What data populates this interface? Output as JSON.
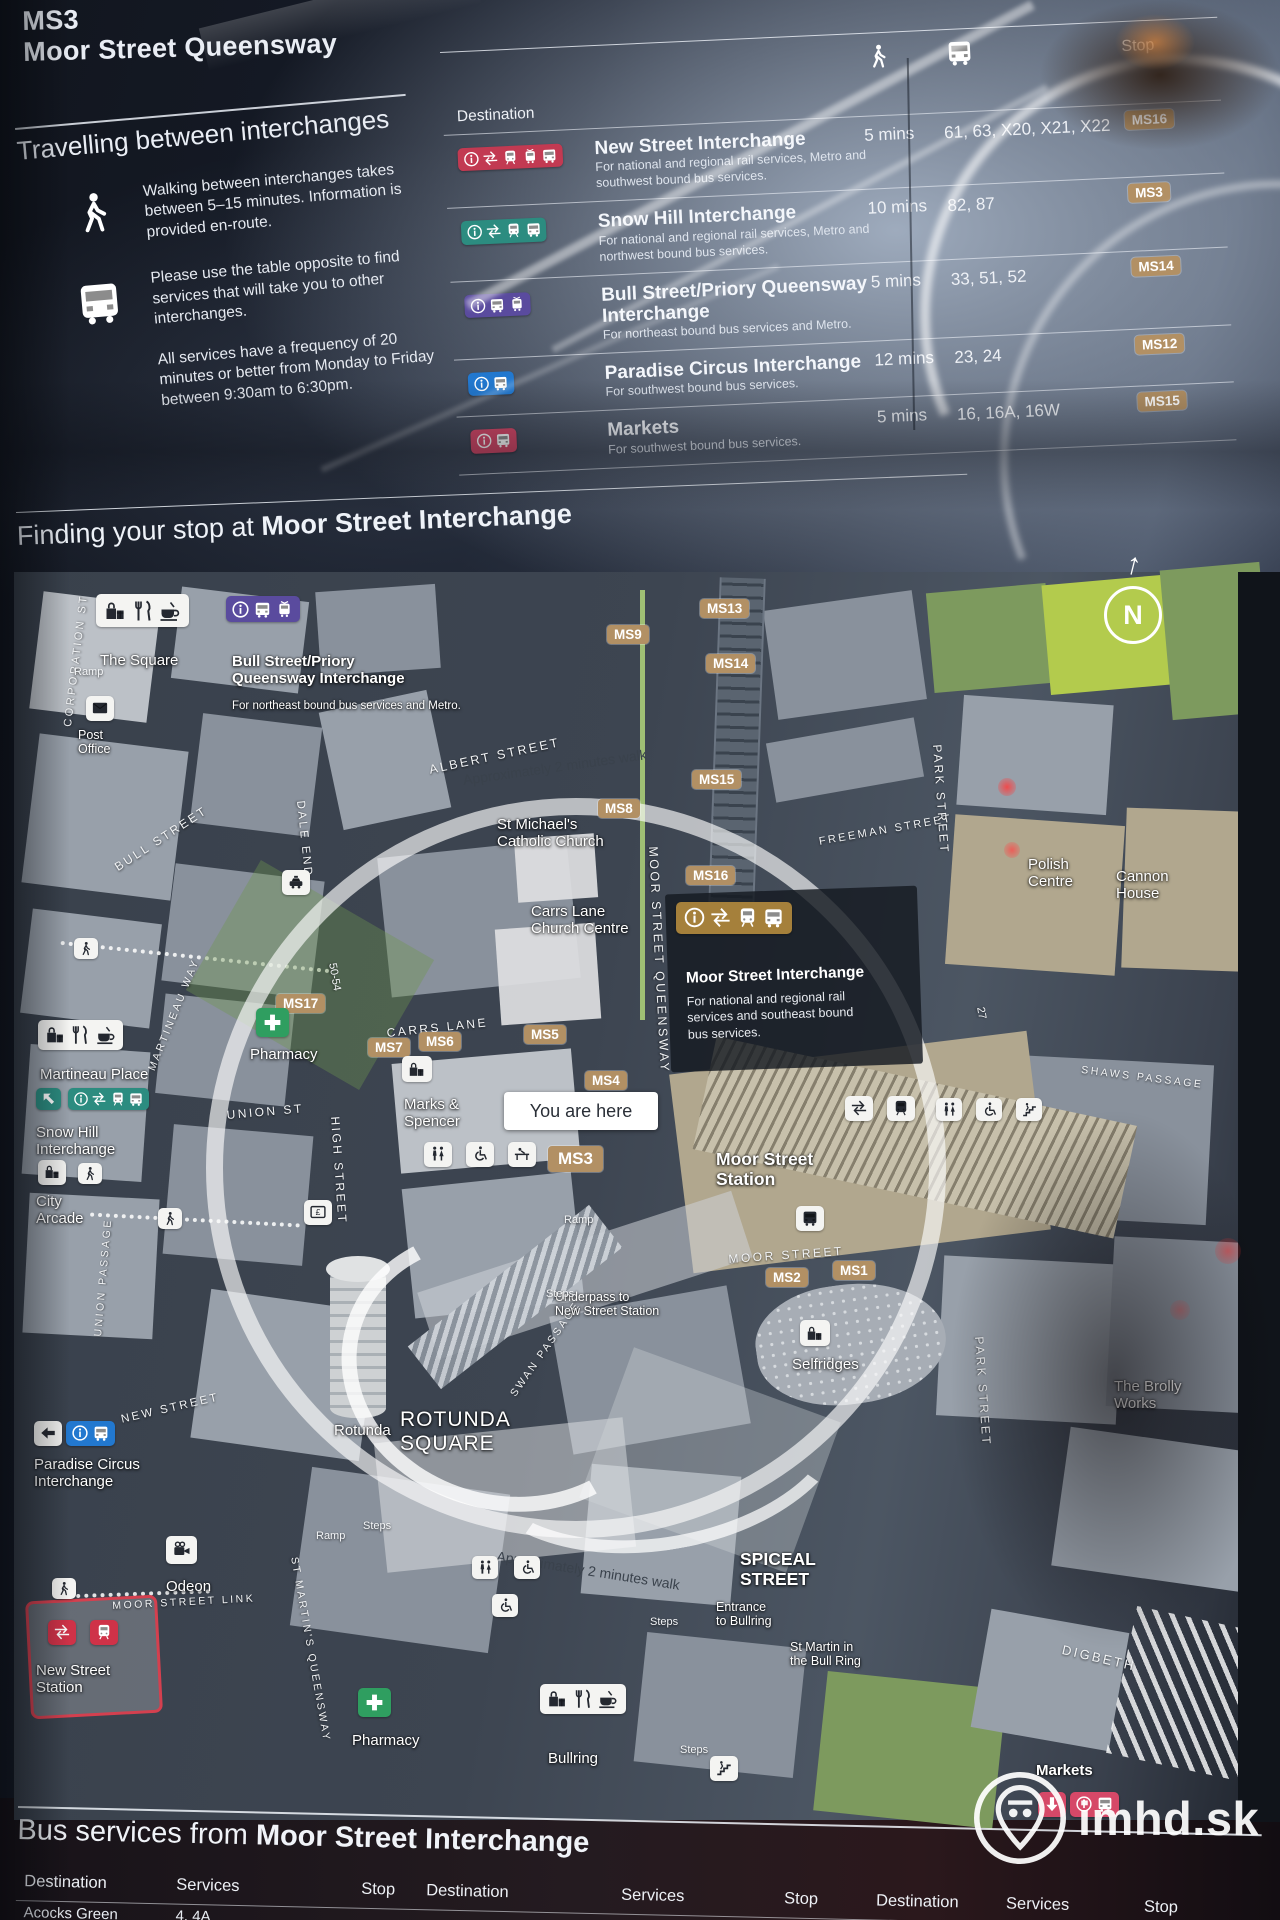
{
  "header": {
    "stop_code": "MS3",
    "stop_name": "Moor Street Queensway"
  },
  "travel_info": {
    "heading": "Travelling between interchanges",
    "walk_note": "Walking between interchanges takes between 5–15 minutes. Information is provided en-route.",
    "bus_note_1": "Please use the table opposite to find services that will take you to other interchanges.",
    "bus_note_2": "All services have a frequency of 20 minutes or better from Monday to Friday between 9:30am to 6:30pm."
  },
  "interchange_table": {
    "destination_header": "Destination",
    "stop_header": "Stop",
    "rows": [
      {
        "title": "New Street Interchange",
        "subtitle": "For national and regional rail services, Metro and southwest bound bus services.",
        "walk_time": "5 mins",
        "services": "61, 63, X20, X21, X22",
        "stop": "MS16",
        "chip_color": "red",
        "chip_icons": [
          "info",
          "rail",
          "train",
          "tram",
          "bus"
        ]
      },
      {
        "title": "Snow Hill Interchange",
        "subtitle": "For national and regional rail services, Metro and northwest bound bus services.",
        "walk_time": "10 mins",
        "services": "82, 87",
        "stop": "MS3",
        "chip_color": "teal",
        "chip_icons": [
          "info",
          "rail",
          "train",
          "bus"
        ]
      },
      {
        "title": "Bull Street/Priory Queensway Interchange",
        "subtitle": "For northeast bound bus services and Metro.",
        "walk_time": "5 mins",
        "services": "33, 51, 52",
        "stop": "MS14",
        "chip_color": "purple",
        "chip_icons": [
          "info",
          "bus",
          "tram"
        ]
      },
      {
        "title": "Paradise Circus Interchange",
        "subtitle": "For southwest bound bus services.",
        "walk_time": "12 mins",
        "services": "23, 24",
        "stop": "MS12",
        "chip_color": "blue",
        "chip_icons": [
          "info",
          "bus"
        ]
      },
      {
        "title": "Markets",
        "subtitle": "For southwest bound bus services.",
        "walk_time": "5 mins",
        "services": "16, 16A, 16W",
        "stop": "MS15",
        "chip_color": "pink",
        "chip_icons": [
          "info",
          "bus"
        ]
      }
    ]
  },
  "map_section": {
    "heading_prefix": "Finding your stop at ",
    "heading_bold": "Moor Street Interchange"
  },
  "map": {
    "you_are_here": "You are here",
    "north": "N",
    "north_arrow": "↑",
    "moor_panel": {
      "title": "Moor Street Interchange",
      "sub": "For national and regional rail\nservices and southeast bound\nbus services."
    },
    "streets": [
      {
        "t": "CORPORATION ST",
        "x": 62,
        "y": 726,
        "r": -83,
        "fs": 11
      },
      {
        "t": "BULL STREET",
        "x": 112,
        "y": 862,
        "r": -33,
        "fs": 12
      },
      {
        "t": "DALE END",
        "x": 306,
        "y": 800,
        "r": 84,
        "fs": 11.5
      },
      {
        "t": "ALBERT STREET",
        "x": 428,
        "y": 763,
        "r": -12,
        "fs": 12.5
      },
      {
        "t": "MARTINEAU WAY",
        "x": 146,
        "y": 1068,
        "r": -68,
        "fs": 10.5
      },
      {
        "t": "UNION ST",
        "x": 226,
        "y": 1108,
        "r": -5,
        "fs": 12
      },
      {
        "t": "HIGH STREET",
        "x": 342,
        "y": 1116,
        "r": 86,
        "fs": 12
      },
      {
        "t": "UNION PASSAGE",
        "x": 92,
        "y": 1336,
        "r": -85,
        "fs": 10.5
      },
      {
        "t": "CARRS LANE",
        "x": 386,
        "y": 1026,
        "r": -6,
        "fs": 12
      },
      {
        "t": "MOOR STREET QUEENSWAY",
        "x": 660,
        "y": 846,
        "r": 87,
        "fs": 12.5
      },
      {
        "t": "FREEMAN STREET",
        "x": 818,
        "y": 836,
        "r": -10,
        "fs": 11
      },
      {
        "t": "PARK STREET",
        "x": 944,
        "y": 744,
        "r": 86,
        "fs": 12
      },
      {
        "t": "PARK STREET",
        "x": 986,
        "y": 1336,
        "r": 86,
        "fs": 12
      },
      {
        "t": "SHAWS PASSAGE",
        "x": 1082,
        "y": 1064,
        "r": 7,
        "fs": 10.5
      },
      {
        "t": "MOOR STREET",
        "x": 728,
        "y": 1252,
        "r": -4,
        "fs": 12
      },
      {
        "t": "SWAN PASSAGE",
        "x": 508,
        "y": 1392,
        "r": -55,
        "fs": 10.5
      },
      {
        "t": "NEW STREET",
        "x": 120,
        "y": 1414,
        "r": -13,
        "fs": 11.5
      },
      {
        "t": "ST MARTIN'S QUEENSWAY",
        "x": 300,
        "y": 1556,
        "r": 80,
        "fs": 10.5
      },
      {
        "t": "MOOR STREET LINK",
        "x": 112,
        "y": 1600,
        "r": -3,
        "fs": 10.5
      },
      {
        "t": "DIGBETH",
        "x": 1064,
        "y": 1642,
        "r": 13,
        "fs": 13
      }
    ],
    "stop_chips": [
      {
        "t": "MS13",
        "x": 700,
        "y": 599
      },
      {
        "t": "MS9",
        "x": 607,
        "y": 625
      },
      {
        "t": "MS14",
        "x": 706,
        "y": 654
      },
      {
        "t": "MS15",
        "x": 692,
        "y": 770
      },
      {
        "t": "MS8",
        "x": 598,
        "y": 799
      },
      {
        "t": "MS16",
        "x": 686,
        "y": 866
      },
      {
        "t": "MS17",
        "x": 276,
        "y": 994
      },
      {
        "t": "MS7",
        "x": 368,
        "y": 1038
      },
      {
        "t": "MS6",
        "x": 419,
        "y": 1032
      },
      {
        "t": "MS5",
        "x": 524,
        "y": 1025
      },
      {
        "t": "MS4",
        "x": 585,
        "y": 1071
      },
      {
        "t": "MS3",
        "x": 548,
        "y": 1146,
        "big": true
      },
      {
        "t": "MS2",
        "x": 766,
        "y": 1268
      },
      {
        "t": "MS1",
        "x": 833,
        "y": 1261
      }
    ],
    "pois": [
      {
        "t": "The Square",
        "x": 100,
        "y": 652,
        "cls": "md"
      },
      {
        "t": "Post\nOffice",
        "x": 78,
        "y": 728,
        "cls": "sm"
      },
      {
        "t": "Bull Street/Priory\nQueensway Interchange",
        "x": 232,
        "y": 653,
        "cls": "md b"
      },
      {
        "t": "For northeast bound bus services and Metro.",
        "x": 232,
        "y": 700,
        "cls": "xs"
      },
      {
        "t": "St Michael's\nCatholic Church",
        "x": 497,
        "y": 816,
        "cls": "md"
      },
      {
        "t": "Carrs Lane\nChurch Centre",
        "x": 531,
        "y": 903,
        "cls": "md"
      },
      {
        "t": "Polish\nCentre",
        "x": 1028,
        "y": 856,
        "cls": "md"
      },
      {
        "t": "Cannon\nHouse",
        "x": 1116,
        "y": 868,
        "cls": "md"
      },
      {
        "t": "Pharmacy",
        "x": 250,
        "y": 1046,
        "cls": "md"
      },
      {
        "t": "Marks &\nSpencer",
        "x": 404,
        "y": 1096,
        "cls": "md"
      },
      {
        "t": "Martineau Place",
        "x": 40,
        "y": 1066,
        "cls": "md"
      },
      {
        "t": "Snow Hill\nInterchange",
        "x": 36,
        "y": 1124,
        "cls": "md"
      },
      {
        "t": "City\nArcade",
        "x": 36,
        "y": 1193,
        "cls": "md"
      },
      {
        "t": "Moor Street\nStation",
        "x": 716,
        "y": 1150,
        "cls": "lg"
      },
      {
        "t": "Underpass to\nNew Street Station",
        "x": 555,
        "y": 1290,
        "cls": "sm"
      },
      {
        "t": "Selfridges",
        "x": 792,
        "y": 1356,
        "cls": "md"
      },
      {
        "t": "Rotunda",
        "x": 334,
        "y": 1422,
        "cls": "md"
      },
      {
        "t": "ROTUNDA\nSQUARE",
        "x": 400,
        "y": 1408,
        "cls": "xl"
      },
      {
        "t": "Paradise Circus\nInterchange",
        "x": 34,
        "y": 1456,
        "cls": "md"
      },
      {
        "t": "Odeon",
        "x": 166,
        "y": 1578,
        "cls": "md"
      },
      {
        "t": "New Street\nStation",
        "x": 36,
        "y": 1662,
        "cls": "md"
      },
      {
        "t": "The Brolly\nWorks",
        "x": 1114,
        "y": 1378,
        "cls": "md"
      },
      {
        "t": "SPICEAL\nSTREET",
        "x": 740,
        "y": 1550,
        "cls": "lg"
      },
      {
        "t": "Entrance\nto Bullring",
        "x": 716,
        "y": 1600,
        "cls": "sm"
      },
      {
        "t": "St Martin in\nthe Bull Ring",
        "x": 790,
        "y": 1640,
        "cls": "sm"
      },
      {
        "t": "Bullring",
        "x": 548,
        "y": 1750,
        "cls": "md"
      },
      {
        "t": "Pharmacy",
        "x": 352,
        "y": 1732,
        "cls": "md"
      },
      {
        "t": "Markets",
        "x": 1036,
        "y": 1762,
        "cls": "md b"
      }
    ],
    "notes": [
      {
        "t": "Approximately 2 minutes walk",
        "x": 462,
        "y": 772,
        "r": -8
      },
      {
        "t": "Approximately 2 minutes walk",
        "x": 498,
        "y": 1548,
        "r": 9
      }
    ],
    "small_labels": [
      {
        "t": "Ramp",
        "x": 74,
        "y": 666
      },
      {
        "t": "Ramp",
        "x": 564,
        "y": 1214
      },
      {
        "t": "Ramp",
        "x": 316,
        "y": 1530
      },
      {
        "t": "Steps",
        "x": 546,
        "y": 1288
      },
      {
        "t": "Steps",
        "x": 363,
        "y": 1520
      },
      {
        "t": "Steps",
        "x": 650,
        "y": 1616
      },
      {
        "t": "Steps",
        "x": 680,
        "y": 1744
      },
      {
        "t": "50-54",
        "x": 338,
        "y": 962,
        "r": 80
      },
      {
        "t": "27",
        "x": 986,
        "y": 1006,
        "r": 80
      }
    ],
    "icon_chips": [
      {
        "x": 96,
        "y": 594,
        "style": "white",
        "icons": [
          "gift",
          "fork",
          "cup"
        ],
        "s": 1.5
      },
      {
        "x": 226,
        "y": 596,
        "style": "purple",
        "icons": [
          "info",
          "bus",
          "tram"
        ],
        "s": 1.2
      },
      {
        "x": 86,
        "y": 696,
        "style": "white",
        "icons": [
          "envelope"
        ],
        "s": 1.1
      },
      {
        "x": 282,
        "y": 870,
        "style": "white",
        "icons": [
          "taxi"
        ],
        "s": 1.1
      },
      {
        "x": 256,
        "y": 1008,
        "style": "green",
        "icons": [
          "cross"
        ],
        "s": 1.3
      },
      {
        "x": 358,
        "y": 1688,
        "style": "green",
        "icons": [
          "cross"
        ],
        "s": 1.3
      },
      {
        "x": 38,
        "y": 1020,
        "style": "white",
        "icons": [
          "gift",
          "fork",
          "cup"
        ],
        "s": 1.35
      },
      {
        "x": 36,
        "y": 1088,
        "style": "teal",
        "icons": [
          "arrow-upleft"
        ],
        "s": 1.0
      },
      {
        "x": 68,
        "y": 1088,
        "style": "teal",
        "icons": [
          "info",
          "rail",
          "train",
          "bus"
        ],
        "s": 1.0
      },
      {
        "x": 38,
        "y": 1160,
        "style": "white",
        "icons": [
          "gift"
        ],
        "s": 1.15
      },
      {
        "x": 74,
        "y": 938,
        "style": "white",
        "icons": [
          "walk"
        ],
        "s": 0.95
      },
      {
        "x": 78,
        "y": 1163,
        "style": "white",
        "icons": [
          "walk"
        ],
        "s": 0.95
      },
      {
        "x": 158,
        "y": 1208,
        "style": "white",
        "icons": [
          "walk"
        ],
        "s": 0.95
      },
      {
        "x": 304,
        "y": 1200,
        "style": "white",
        "icons": [
          "cash"
        ],
        "s": 1.1
      },
      {
        "x": 402,
        "y": 1056,
        "style": "white",
        "icons": [
          "gift"
        ],
        "s": 1.2
      },
      {
        "x": 424,
        "y": 1142,
        "style": "white",
        "icons": [
          "toilets"
        ],
        "s": 1.1
      },
      {
        "x": 466,
        "y": 1142,
        "style": "white",
        "icons": [
          "wheelchair"
        ],
        "s": 1.1
      },
      {
        "x": 508,
        "y": 1142,
        "style": "white",
        "icons": [
          "baby"
        ],
        "s": 1.1
      },
      {
        "x": 676,
        "y": 902,
        "style": "gold",
        "icons": [
          "info",
          "rail",
          "train",
          "bus"
        ],
        "s": 1.45
      },
      {
        "x": 845,
        "y": 1096,
        "style": "white",
        "icons": [
          "rail"
        ],
        "s": 1.15
      },
      {
        "x": 887,
        "y": 1096,
        "style": "white",
        "icons": [
          "train"
        ],
        "s": 1.15
      },
      {
        "x": 936,
        "y": 1098,
        "style": "white",
        "icons": [
          "toilets"
        ],
        "s": 1.05
      },
      {
        "x": 976,
        "y": 1098,
        "style": "white",
        "icons": [
          "wheelchair"
        ],
        "s": 1.05
      },
      {
        "x": 1016,
        "y": 1098,
        "style": "white",
        "icons": [
          "stairs"
        ],
        "s": 1.05
      },
      {
        "x": 796,
        "y": 1206,
        "style": "white",
        "icons": [
          "bus"
        ],
        "s": 1.15
      },
      {
        "x": 800,
        "y": 1320,
        "style": "white",
        "icons": [
          "gift"
        ],
        "s": 1.2
      },
      {
        "x": 166,
        "y": 1536,
        "style": "white",
        "icons": [
          "camera"
        ],
        "s": 1.25
      },
      {
        "x": 52,
        "y": 1578,
        "style": "white",
        "icons": [
          "walk"
        ],
        "s": 0.95
      },
      {
        "x": 48,
        "y": 1620,
        "style": "red2",
        "icons": [
          "rail"
        ],
        "s": 1.15
      },
      {
        "x": 90,
        "y": 1620,
        "style": "red2",
        "icons": [
          "train"
        ],
        "s": 1.15
      },
      {
        "x": 34,
        "y": 1421,
        "style": "white",
        "icons": [
          "arrow-left"
        ],
        "s": 1.1
      },
      {
        "x": 66,
        "y": 1421,
        "style": "blue",
        "icons": [
          "info",
          "bus"
        ],
        "s": 1.1
      },
      {
        "x": 540,
        "y": 1684,
        "style": "white",
        "icons": [
          "gift",
          "fork",
          "cup"
        ],
        "s": 1.4
      },
      {
        "x": 710,
        "y": 1756,
        "style": "white",
        "icons": [
          "stairs"
        ],
        "s": 1.1
      },
      {
        "x": 1038,
        "y": 1792,
        "style": "pink",
        "icons": [
          "arrow-down"
        ],
        "s": 1.15
      },
      {
        "x": 1070,
        "y": 1792,
        "style": "pink",
        "icons": [
          "info",
          "bus"
        ],
        "s": 1.15
      },
      {
        "x": 472,
        "y": 1556,
        "style": "white",
        "icons": [
          "toilets"
        ],
        "s": 1.05
      },
      {
        "x": 514,
        "y": 1556,
        "style": "white",
        "icons": [
          "wheelchair"
        ],
        "s": 1.05
      },
      {
        "x": 492,
        "y": 1594,
        "style": "white",
        "icons": [
          "wheelchair"
        ],
        "s": 1.05
      }
    ]
  },
  "bottom_table": {
    "heading_prefix": "Bus services from ",
    "heading_bold": "Moor Street Interchange",
    "groups": [
      {
        "headers": [
          "Destination",
          "Services",
          "Stop"
        ],
        "rows": [
          {
            "dest": "Acocks Green",
            "services": "4, 4A",
            "stop": ""
          },
          {
            "dest": "Alcester Lanes End",
            "services": "50, 50A, 15",
            "stop": "MS5"
          }
        ]
      },
      {
        "headers": [
          "Destination",
          "Services",
          "Stop"
        ],
        "rows": [
          {
            "dest": "Harborne",
            "services": "",
            "stop": ""
          }
        ],
        "row_start": 0.5
      },
      {
        "headers": [
          "Destination",
          "Services",
          "Stop"
        ],
        "rows": []
      }
    ]
  },
  "watermark": {
    "text": "imhd.sk"
  },
  "colors": {
    "chip_red": "#c23a52",
    "chip_teal": "#2c8c80",
    "chip_purple": "#5a4b9e",
    "chip_blue": "#2278cf",
    "chip_pink": "#d64868",
    "chip_gold": "#a5803b",
    "chip_green": "#2f9e60",
    "chip_red2": "#cf3248",
    "stop_tan": "#b29064",
    "map_road": "#3d4551",
    "map_building": "#939ba5"
  }
}
